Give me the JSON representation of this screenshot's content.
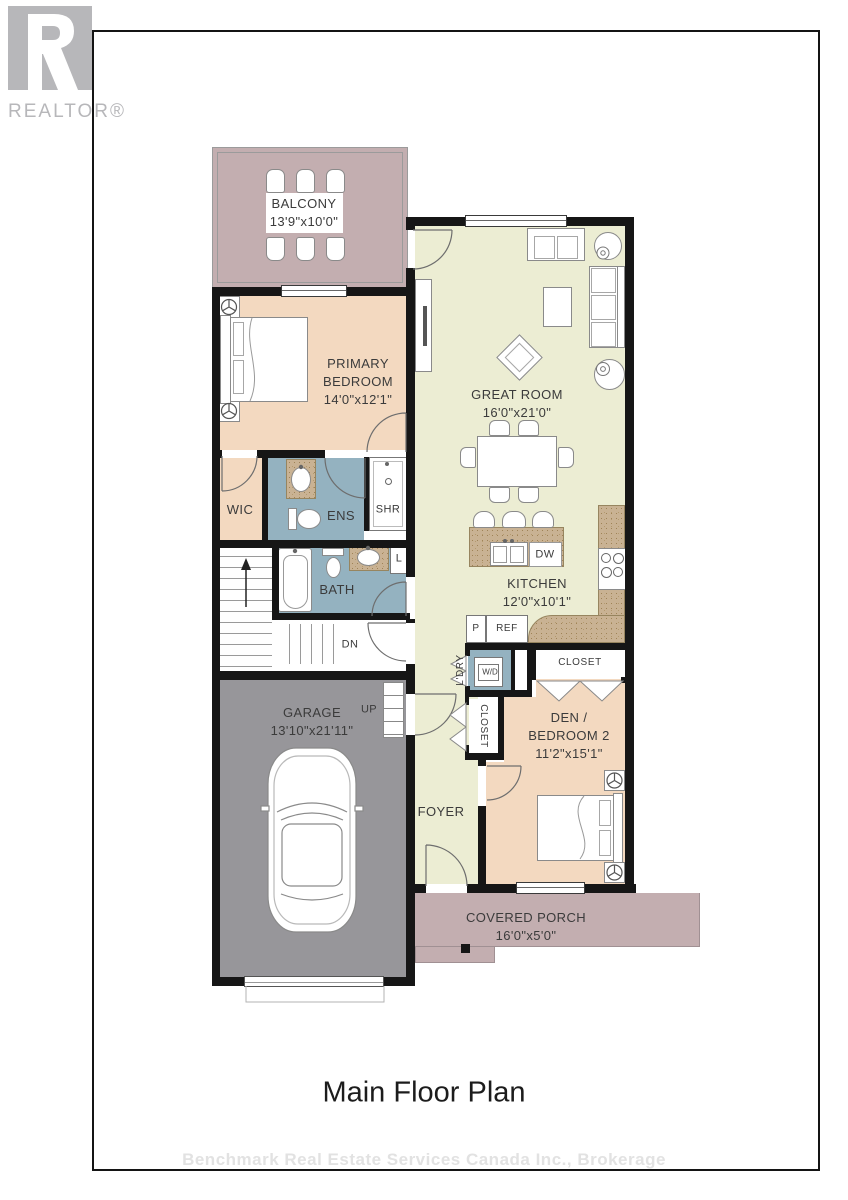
{
  "colors": {
    "wall": "#161616",
    "peach": "#f3d9c0",
    "sage": "#ecedd3",
    "mauve": "#c3aeb0",
    "bathblue": "#94b2c0",
    "garage": "#97969a",
    "granite": "#c9b293",
    "label": "#3b3b3b",
    "logo": "#b7b7ba",
    "watermark": "#e2e2e2"
  },
  "logo": {
    "brand": "REALTOR®"
  },
  "plan": {
    "balcony": {
      "name": "BALCONY",
      "dims": "13'9\"x10'0\""
    },
    "primary_bedroom": {
      "name": "PRIMARY BEDROOM",
      "dims": "14'0\"x12'1\""
    },
    "great_room": {
      "name": "GREAT ROOM",
      "dims": "16'0\"x21'0\""
    },
    "wic": {
      "name": "WIC"
    },
    "ens": {
      "name": "ENS"
    },
    "shr": {
      "name": "SHR"
    },
    "bath": {
      "name": "BATH"
    },
    "linen": {
      "name": "L"
    },
    "kitchen": {
      "name": "KITCHEN",
      "dims": "12'0\"x10'1\""
    },
    "dishwasher": {
      "name": "DW"
    },
    "pantry": {
      "name": "P"
    },
    "fridge": {
      "name": "REF"
    },
    "laundry": {
      "name": "L'DRY"
    },
    "washer_dryer": {
      "name": "W/D"
    },
    "closet_den": {
      "name": "CLOSET"
    },
    "closet_foyer": {
      "name": "CLOSET"
    },
    "den": {
      "name": "DEN / BEDROOM 2",
      "dims": "11'2\"x15'1\""
    },
    "foyer": {
      "name": "FOYER"
    },
    "garage": {
      "name": "GARAGE",
      "dims": "13'10\"x21'11\""
    },
    "up": {
      "name": "UP"
    },
    "dn": {
      "name": "DN"
    },
    "porch": {
      "name": "COVERED PORCH",
      "dims": "16'0\"x5'0\""
    }
  },
  "footer": {
    "title": "Main Floor Plan",
    "watermark": "Benchmark Real Estate Services Canada Inc., Brokerage"
  }
}
